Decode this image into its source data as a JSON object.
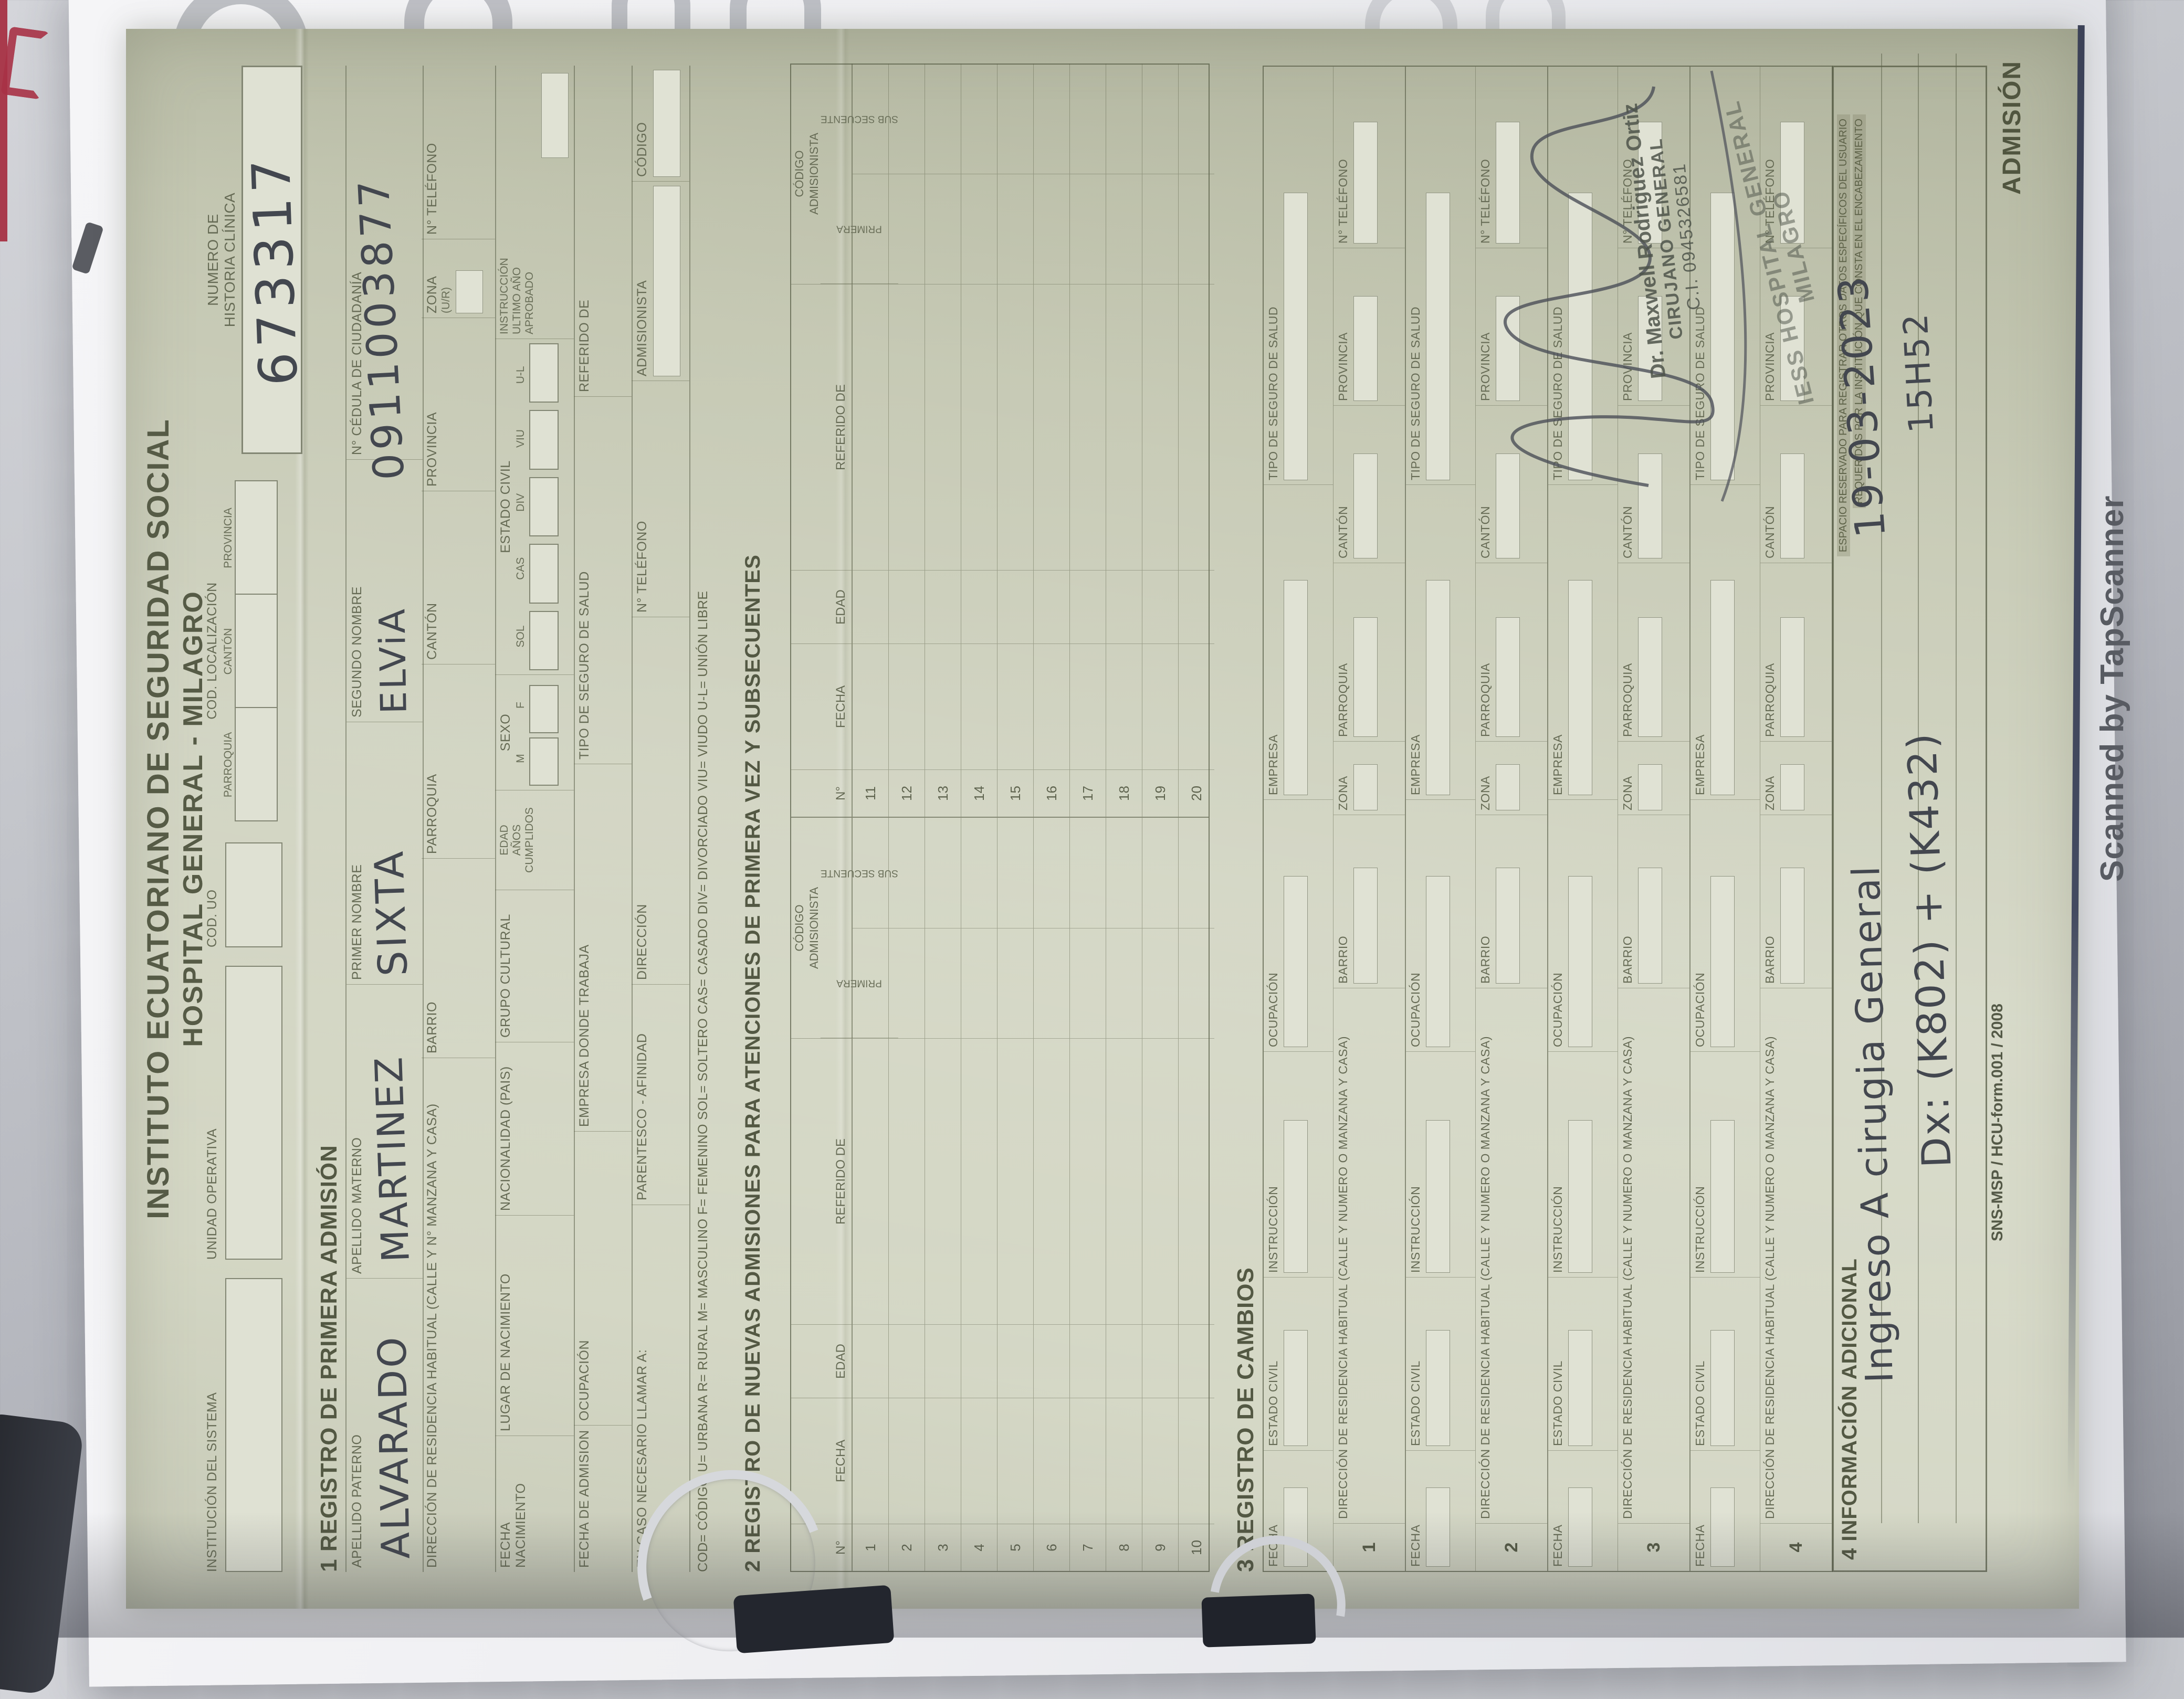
{
  "watermark": "Scanned by TapScanner",
  "header": {
    "title1": "INSTITUTO ECUATORIANO DE SEGURIDAD SOCIAL",
    "title2": "HOSPITAL GENERAL - MILAGRO",
    "institucion_sistema": "INSTITUCIÓN DEL SISTEMA",
    "unidad_operativa": "UNIDAD OPERATIVA",
    "cod_uo": "COD. UO",
    "cod_localizacion": "COD. LOCALIZACIÓN",
    "parroquia": "PARROQUIA",
    "canton": "CANTÓN",
    "provincia": "PROVINCIA",
    "numero_de": "NUMERO DE",
    "historia_clinica": "HISTORIA CLÍNICA",
    "historia_value": "673317"
  },
  "section1": {
    "title": "1   REGISTRO DE PRIMERA ADMISIÓN",
    "apellido_paterno": "APELLIDO PATERNO",
    "apellido_materno": "APELLIDO MATERNO",
    "primer_nombre": "PRIMER NOMBRE",
    "segundo_nombre": "SEGUNDO NOMBRE",
    "cedula": "N° CÉDULA DE CIUDADANÍA",
    "v_apellido_paterno": "ALVARADO",
    "v_apellido_materno": "MARTINEZ",
    "v_primer_nombre": "SIXTA",
    "v_segundo_nombre": "ELViA",
    "v_cedula": "0911003877",
    "direccion": "DIRECCIÓN DE RESIDENCIA HABITUAL    (CALLE Y N°   MANZANA Y CASA)",
    "barrio": "BARRIO",
    "zona": "ZONA",
    "zona_sub": "(U/R)",
    "telefono": "N° TELÉFONO",
    "fecha_nacimiento": "FECHA NACIMIENTO",
    "lugar_nacimiento": "LUGAR DE NACIMIENTO",
    "nacionalidad": "NACIONALIDAD (PAIS)",
    "grupo_cultural": "GRUPO CULTURAL",
    "edad": "EDAD",
    "anos": "AÑOS",
    "cumplidos": "CUMPLIDOS",
    "sexo": "SEXO",
    "m": "M",
    "f": "F",
    "estado_civil": "ESTADO CIVIL",
    "sol": "SOL",
    "cas": "CAS",
    "div": "DIV",
    "viu": "VIU",
    "ul": "U-L",
    "instruccion": "INSTRUCCIÓN",
    "ultimo_ano": "ULTIMO AÑO",
    "aprobado": "APROBADO",
    "fecha_admision": "FECHA DE ADMISION",
    "ocupacion": "OCUPACIÓN",
    "empresa_trabaja": "EMPRESA DONDE TRABAJA",
    "tipo_seguro": "TIPO DE SEGURO DE SALUD",
    "referido_de": "REFERIDO DE",
    "llamar_a": "EN CASO NECESARIO LLAMAR A:",
    "parentesco": "PARENTESCO - AFINIDAD",
    "direccion2": "DIRECCIÓN",
    "telefono2": "N° TELÉFONO",
    "admisionista": "ADMISIONISTA",
    "codigo": "CÓDIGO"
  },
  "legend": "COD= CÓDIGO      U= URBANA     R= RURAL     M= MASCULINO     F= FEMENINO     SOL= SOLTERO     CAS= CASADO     DIV= DIVORCIADO     VIU= VIUDO     U-L= UNIÓN LIBRE",
  "section2": {
    "title": "2   REGISTRO DE NUEVAS ADMISIONES PARA ATENCIONES DE PRIMERA VEZ Y SUBSECUENTES",
    "col_n": "N°",
    "col_fecha": "FECHA",
    "col_edad": "EDAD",
    "col_ref": "REFERIDO DE",
    "col_cod1": "CÓDIGO",
    "col_cod2": "ADMISIONISTA",
    "col_pri": "PRIMERA",
    "col_sub": "SUB SECUENTE",
    "rows_left": [
      "1",
      "2",
      "3",
      "4",
      "5",
      "6",
      "7",
      "8",
      "9",
      "10"
    ],
    "rows_right": [
      "11",
      "12",
      "13",
      "14",
      "15",
      "16",
      "17",
      "18",
      "19",
      "20"
    ]
  },
  "section3": {
    "title": "3   REGISTRO DE CAMBIOS",
    "row1": [
      "FECHA",
      "ESTADO CIVIL",
      "INSTRUCCIÓN",
      "OCUPACIÓN",
      "EMPRESA",
      "TIPO DE SEGURO DE SALUD"
    ],
    "row2": [
      "DIRECCIÓN DE RESIDENCIA HABITUAL   (CALLE Y NUMERO O MANZANA Y CASA)",
      "BARRIO",
      "ZONA",
      "PARROQUIA",
      "CANTÓN",
      "PROVINCIA",
      "N° TELÉFONO"
    ],
    "blocks": [
      "1",
      "2",
      "3",
      "4"
    ]
  },
  "section4": {
    "title": "4   INFORMACIÓN ADICIONAL",
    "note1": "ESPACIO RESERVADO PARA REGISTRAR OTROS DATOS ESPECÍFICOS DEL USUARIO",
    "note2": "REQUERIDOS POR LA INSTITUCIÓN QUE CONSTA EN EL ENCABEZAMIENTO",
    "hw_line1": "Ingreso A cirugia General",
    "hw_date": "19-03-2023",
    "hw_dx": "Dx: (K802) + (K432)",
    "hw_time": "15H52",
    "stamp_doctor_1": "Dr. Maxwell Rodriguez Ortiz",
    "stamp_doctor_2": "CIRUJANO GENERAL",
    "stamp_doctor_3": "C.I. 0945326581",
    "stamp_hospital": "IESS HOSPITAL GENERAL MILAGRO"
  },
  "footer": {
    "left": "SNS-MSP / HCU-form.001 / 2008",
    "right": "ADMISIÓN"
  }
}
